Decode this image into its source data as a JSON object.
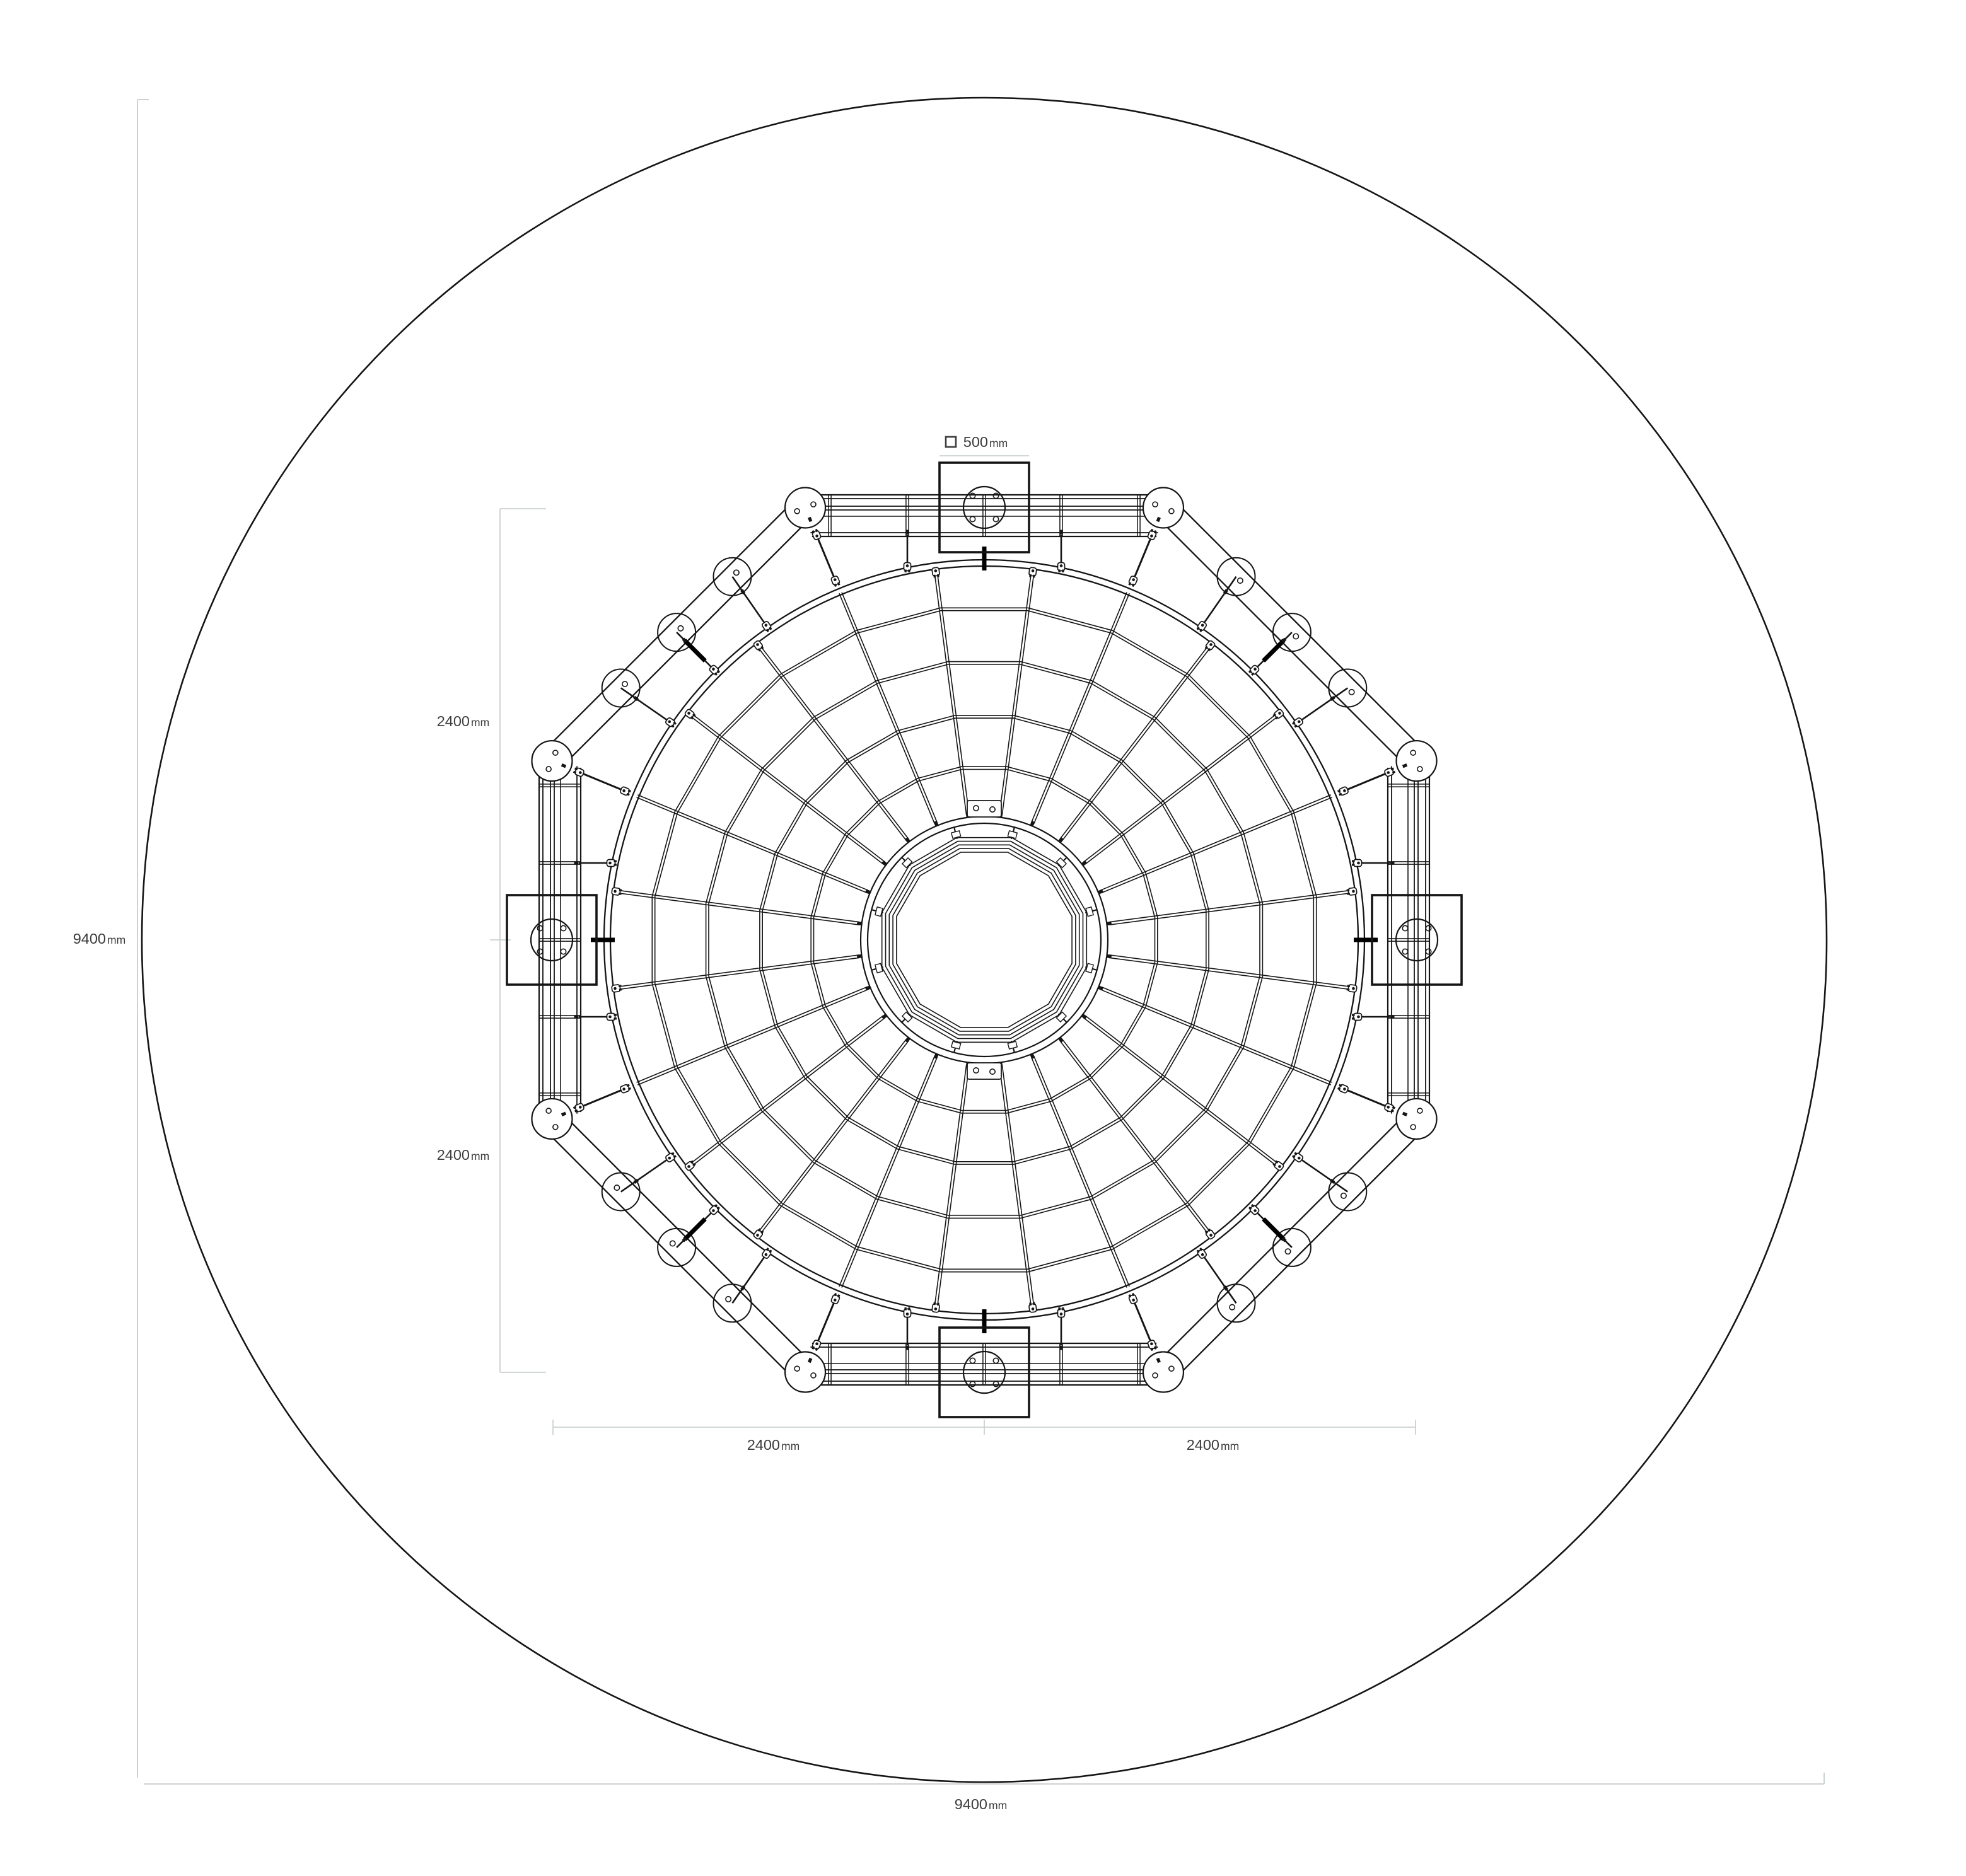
{
  "palette": {
    "line": "#151515",
    "tick": "#000000",
    "dim_line": "#ccd2cf",
    "text": "#3d3d3d",
    "background": "#ffffff"
  },
  "dimensions": {
    "plate": {
      "value": "500",
      "unit": "mm"
    },
    "left_upper_half": {
      "value": "2400",
      "unit": "mm"
    },
    "left_lower_half": {
      "value": "2400",
      "unit": "mm"
    },
    "left_overall": {
      "value": "9400",
      "unit": "mm"
    },
    "bottom_left_half": {
      "value": "2400",
      "unit": "mm"
    },
    "bottom_right_half": {
      "value": "2400",
      "unit": "mm"
    },
    "bottom_overall": {
      "value": "9400",
      "unit": "mm"
    }
  }
}
